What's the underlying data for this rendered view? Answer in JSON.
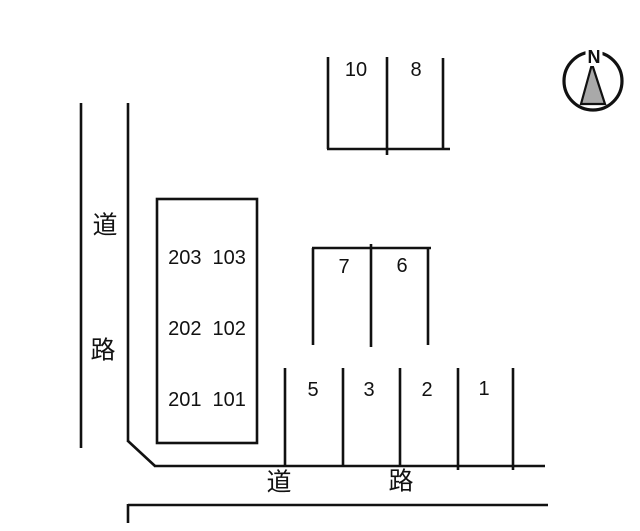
{
  "compass": {
    "north": "N"
  },
  "roads": {
    "left": {
      "label_top": "道",
      "label_bottom": "路"
    },
    "bottom": {
      "label_left": "道",
      "label_right": "路"
    }
  },
  "building": {
    "rooms": [
      [
        "203",
        "103"
      ],
      [
        "202",
        "102"
      ],
      [
        "201",
        "101"
      ]
    ]
  },
  "parking": {
    "north_block": {
      "spaces": [
        "10",
        "8"
      ]
    },
    "middle_block": {
      "spaces": [
        "7",
        "6"
      ]
    },
    "south_row": {
      "spaces": [
        "5",
        "3",
        "2",
        "1"
      ]
    }
  }
}
